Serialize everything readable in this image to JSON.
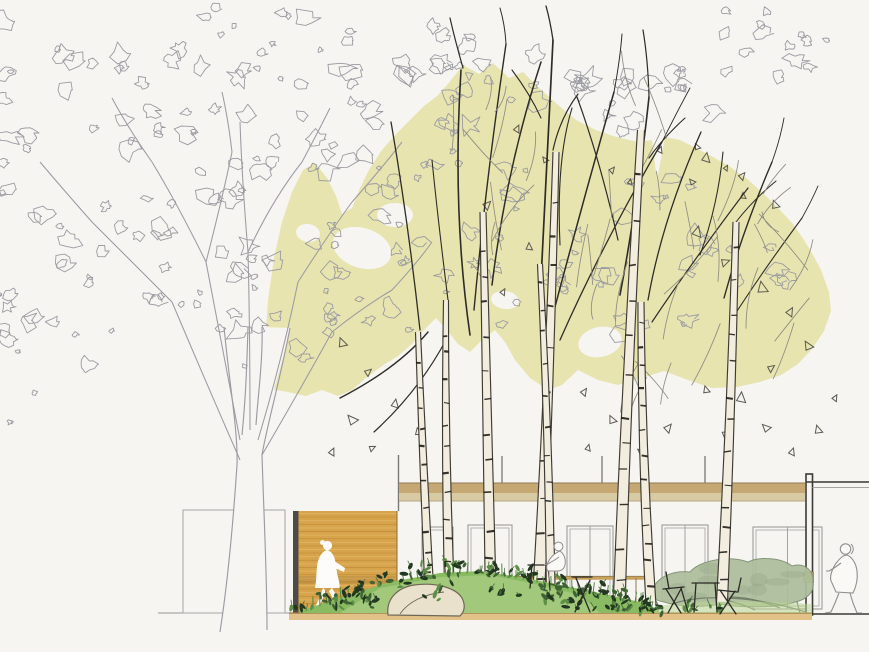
{
  "scene": {
    "type": "architectural-section-elevation-drawing",
    "subject": "Courtyard section: birch grove with pale green canopy growing through a glass pavilion, hand-sketched outline tree at left, wood-slat wall, planted mound with boulder, cafe furniture and three human scale figures",
    "text_content": "none",
    "figure_count": 3,
    "birch_trunk_count": 8
  },
  "colors": {
    "background": "#F6F5F2",
    "outline_tree": "#9B9BA2",
    "canopy": "#E7E4AF",
    "birch_fill": "#F2EDDE",
    "birch_edge": "#3E3B33",
    "birch_mark": "#201E1A",
    "branch_dark": "#2E2C27",
    "twig_light": "#8E8C82",
    "leaf_triangle": "#5C5A50",
    "wood_wall": "#D7A44B",
    "wood_slat_dark": "#C18E3B",
    "wood_slat_light": "#E2B668",
    "wall_edge_dark": "#4D4B47",
    "beam_top": "#C5A873",
    "beam_bottom": "#D8CBA4",
    "beam_edge": "#8F7C52",
    "frame_gray": "#A3A3A1",
    "column_dark": "#3B3A36",
    "ground_fill": "#E2C288",
    "ground_edge": "#96793B",
    "ground_line": "#9A9892",
    "mound_green": "#8ABB63",
    "mound_light": "#B9D693",
    "grass": "#53863F",
    "leaf_dark": "#22371F",
    "leaf_mid": "#3F6234",
    "leaf_bright": "#5E8F46",
    "boulder_fill": "#E9E1CB",
    "boulder_edge": "#6F6858",
    "interior_tree_fill": "#ACBE9B",
    "interior_tree_edge": "#7E8F73",
    "interior_branch": "#68765F",
    "furniture_dark": "#2B2A26",
    "figure_outline": "#8F8F8F",
    "figure_fill": "#FAF9F6",
    "silhouette_white": "#FDFCFA",
    "rail_tan": "#C9A25C",
    "annex_line": "#ACACAC"
  },
  "elements": {
    "outline_tree": "line-art deciduous tree",
    "canopy": "yellow-green birch canopy mass with leaf-fall",
    "birch_grove": "multi-stem birch trunks with lenticel marks",
    "pavilion": "flat-roof glass pavilion with timber fascia",
    "wood_wall": "horizontal timber slat wall with walking silhouette",
    "mound": "planted mound with boulder and shrubs",
    "interior_tree": "sage-green courtyard tree behind glazing",
    "furniture": "bistro chairs and tables",
    "figures": "walking silhouette, seated person, walking person"
  }
}
